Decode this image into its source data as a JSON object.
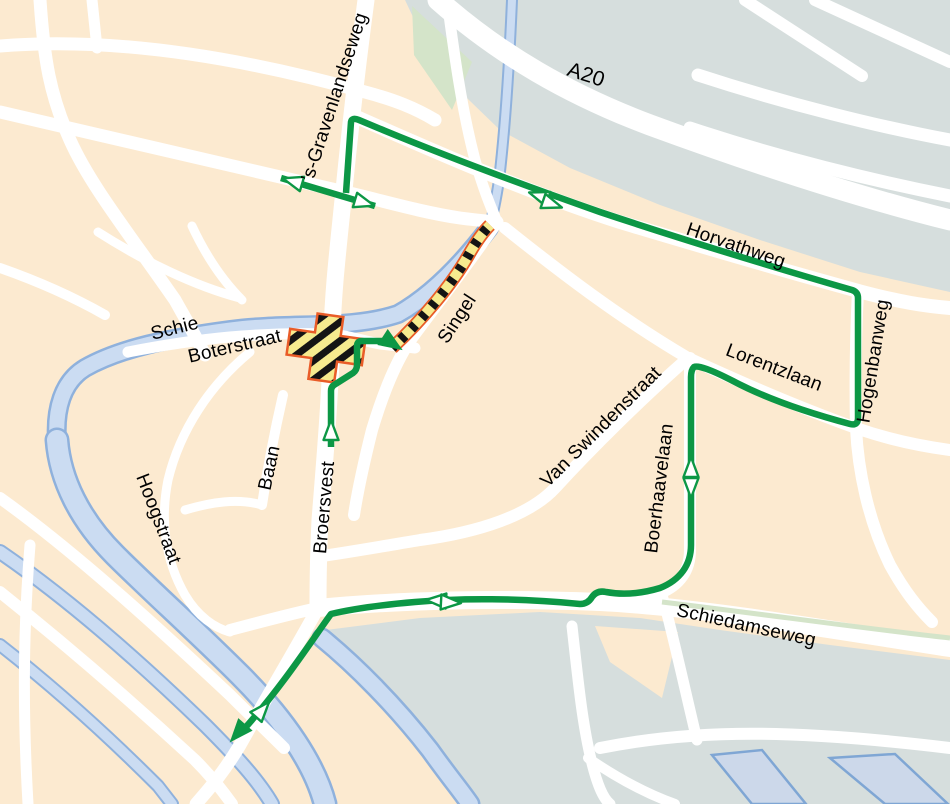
{
  "map": {
    "type": "detour-roadworks-map",
    "city_area": "Schiedam"
  },
  "labels": {
    "schie": "Schie",
    "boterstraat": "Boterstraat",
    "gravenlandseweg": "’s-Gravenlandseweg",
    "a20": "A20",
    "horvathweg": "Horvathweg",
    "hogenbanweg": "Hogenbanweg",
    "lorentzlaan": "Lorentzlaan",
    "vanswindenstraat": "Van Swindenstraat",
    "boerhaavelaan": "Boerhaavelaan",
    "schiedamseweg": "Schiedamseweg",
    "singel": "Singel",
    "baan": "Baan",
    "broersvest": "Broersvest",
    "hoogstraat": "Hoogstraat"
  },
  "colors": {
    "land": "#fcead0",
    "road": "#ffffff",
    "infrastructure_gray": "#d6dedd",
    "green_verge": "#d4e4c9",
    "water_fill": "#cbdcf2",
    "water_edge": "#8fb1dc",
    "basin_fill": "#ccd8ea",
    "basin_edge": "#7fa6d4",
    "detour_route_green": "#0c9745",
    "roadworks_yellow": "#f6eb8f",
    "roadworks_black": "#141414",
    "roadworks_border": "#e95c28"
  }
}
